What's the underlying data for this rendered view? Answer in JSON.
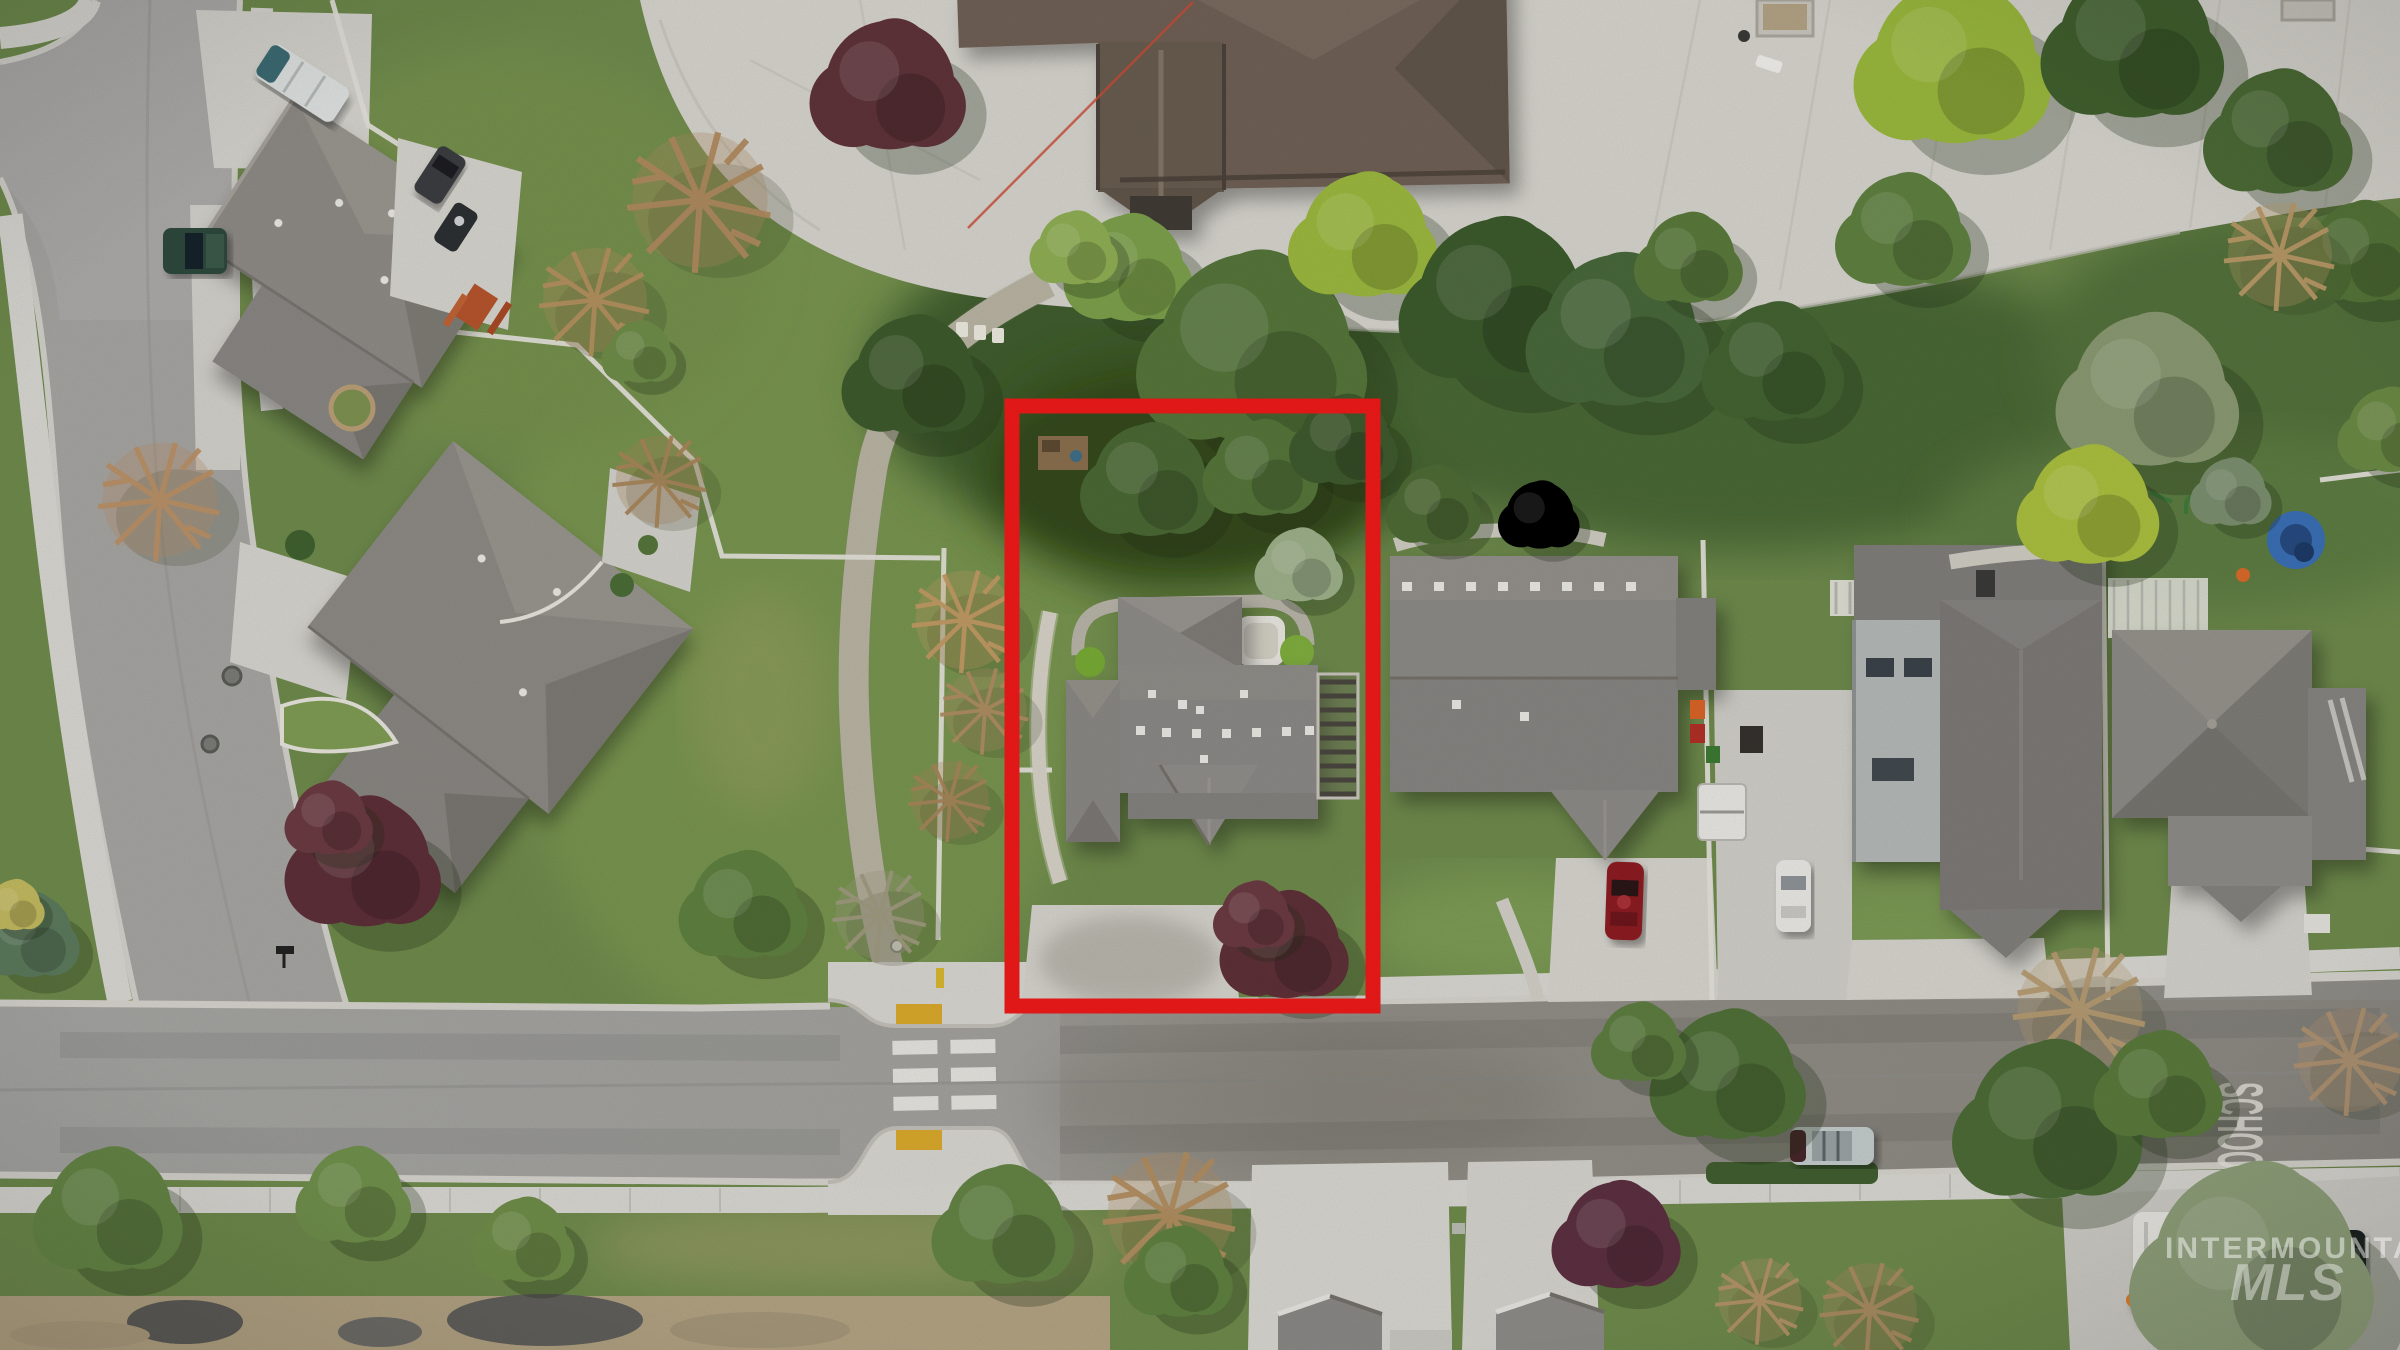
{
  "photo": {
    "kind": "aerial-drone-photo",
    "subject": "residential neighborhood with subject property outlined in red next to a school plaza"
  },
  "watermark": {
    "line1": "INTERMOUNTAIN",
    "line2": "MLS",
    "color": "#ffffff"
  },
  "road_marking": {
    "text": "SCHOOL",
    "color": "#edebe2"
  },
  "property_outline": {
    "color": "#ee1a19",
    "x": 1012,
    "y": 406,
    "width": 361,
    "height": 600,
    "stroke_width": 15
  },
  "palette": {
    "grass": "#6e8a4c",
    "grass_dark": "#46602f",
    "backyard_dark": "#3c5328",
    "asphalt": "#a3a3a0",
    "asphalt_warm": "#95928b",
    "concrete": "#d7d5cf",
    "plaza": "#d6d4cd",
    "gravel_path": "#c4bdae",
    "school_roof": "#6f6156",
    "house_roof_gray": "#8b8986",
    "house_roof_dark": "#7b7976",
    "tree_green": "#55753a",
    "tree_dark_green": "#3e5a2c",
    "tree_chartreuse": "#9cb83f",
    "tree_purple": "#5d3038",
    "tree_bare_tan": "#b08a5f",
    "tactile_yellow": "#d9a92c",
    "crosswalk_white": "#eceae4",
    "fence_white": "#e4e2da"
  },
  "objects": {
    "cars": [
      {
        "name": "green-pickup-truck",
        "color": "#2e4a3c"
      },
      {
        "name": "dark-suv-by-house",
        "color": "#3b3e41"
      },
      {
        "name": "rv-trailer",
        "color": "#dfe3e2"
      },
      {
        "name": "red-car",
        "color": "#8c1f24"
      },
      {
        "name": "white-car",
        "color": "#e9e8e4"
      },
      {
        "name": "silver-suv-on-road",
        "color": "#c3cbcb"
      },
      {
        "name": "white-van",
        "color": "#e8e7e2"
      },
      {
        "name": "black-car",
        "color": "#1f2224"
      }
    ],
    "features": [
      "school-building",
      "concrete-plaza",
      "planters",
      "walking-path",
      "crosswalk-with-bulbouts",
      "tactile-pads",
      "red-property-outline",
      "hot-tub",
      "pergola",
      "blue-kiddie-pool",
      "picnic-table",
      "purple-maple-trees",
      "gravel-piles"
    ]
  }
}
